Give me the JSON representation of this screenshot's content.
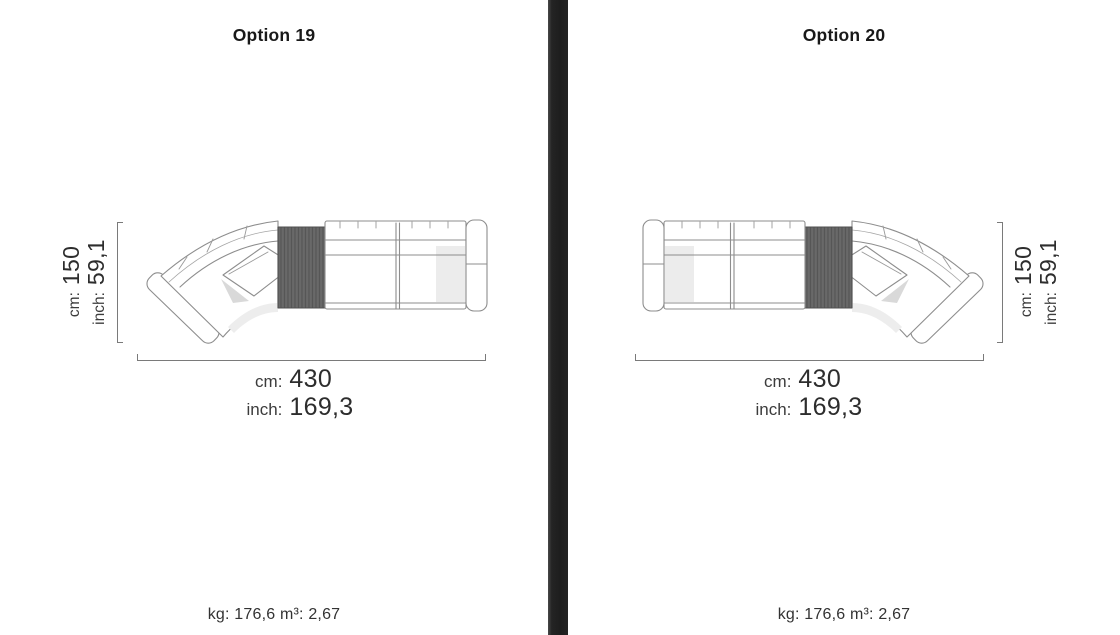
{
  "ui": {
    "divider_color": "#1f1f1f",
    "title_color": "#191919",
    "dimension_text_color": "#2d2d2d",
    "drawing_line_color": "#8d8d8d",
    "console_table_fill": "#696969"
  },
  "panels": [
    {
      "title": "Option 19",
      "layout": "chaise-left",
      "depth": {
        "cm_label": "cm:",
        "cm_value": "150",
        "inch_label": "inch:",
        "inch_value": "59,1"
      },
      "width": {
        "cm_label": "cm:",
        "cm_value": "430",
        "inch_label": "inch:",
        "inch_value": "169,3"
      },
      "weight_volume": "kg: 176,6 m³: 2,67"
    },
    {
      "title": "Option 20",
      "layout": "chaise-right",
      "depth": {
        "cm_label": "cm:",
        "cm_value": "150",
        "inch_label": "inch:",
        "inch_value": "59,1"
      },
      "width": {
        "cm_label": "cm:",
        "cm_value": "430",
        "inch_label": "inch:",
        "inch_value": "169,3"
      },
      "weight_volume": "kg: 176,6 m³: 2,67"
    }
  ]
}
